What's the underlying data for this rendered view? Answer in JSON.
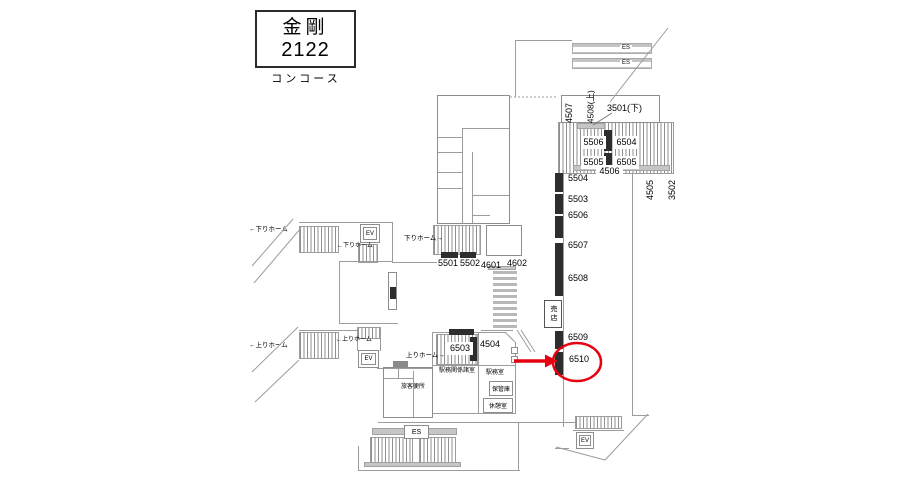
{
  "title": {
    "station": "金剛",
    "code": "2122",
    "area": "コンコース"
  },
  "es_labels": {
    "top1": "ES",
    "top2": "ES",
    "bottom": "ES"
  },
  "ev_labels": {
    "down": "EV",
    "up": "EV",
    "south": "EV"
  },
  "platforms": {
    "down_left": "←下りホーム",
    "down_mid": "←下りホーム",
    "down_right": "下りホーム→",
    "up_left": "←上りホーム",
    "up_mid": "←上りホーム",
    "up_right": "上りホーム→"
  },
  "rooms": {
    "station_office_rooms": "駅務関係諸室",
    "station_office": "駅務室",
    "storage": "保管庫",
    "rest_room": "休憩室",
    "passenger_toilet": "旅客便所",
    "kiosk": "売店"
  },
  "ads": {
    "p4507": "4507",
    "p4508": "4508(上)",
    "p3501": "3501(下)",
    "p5506": "5506",
    "p6504": "6504",
    "p5505": "5505",
    "p6505": "6505",
    "p4506": "4506",
    "p4505": "4505",
    "p3502": "3502",
    "p5504": "5504",
    "p5503": "5503",
    "p6506": "6506",
    "p6507": "6507",
    "p6508": "6508",
    "p6509": "6509",
    "p6510": "6510",
    "p5501": "5501",
    "p5502": "5502",
    "p4601": "4601",
    "p4602": "4602",
    "p6503": "6503",
    "p4504": "4504"
  },
  "highlight": {
    "target": "6510",
    "color": "#e60012"
  }
}
